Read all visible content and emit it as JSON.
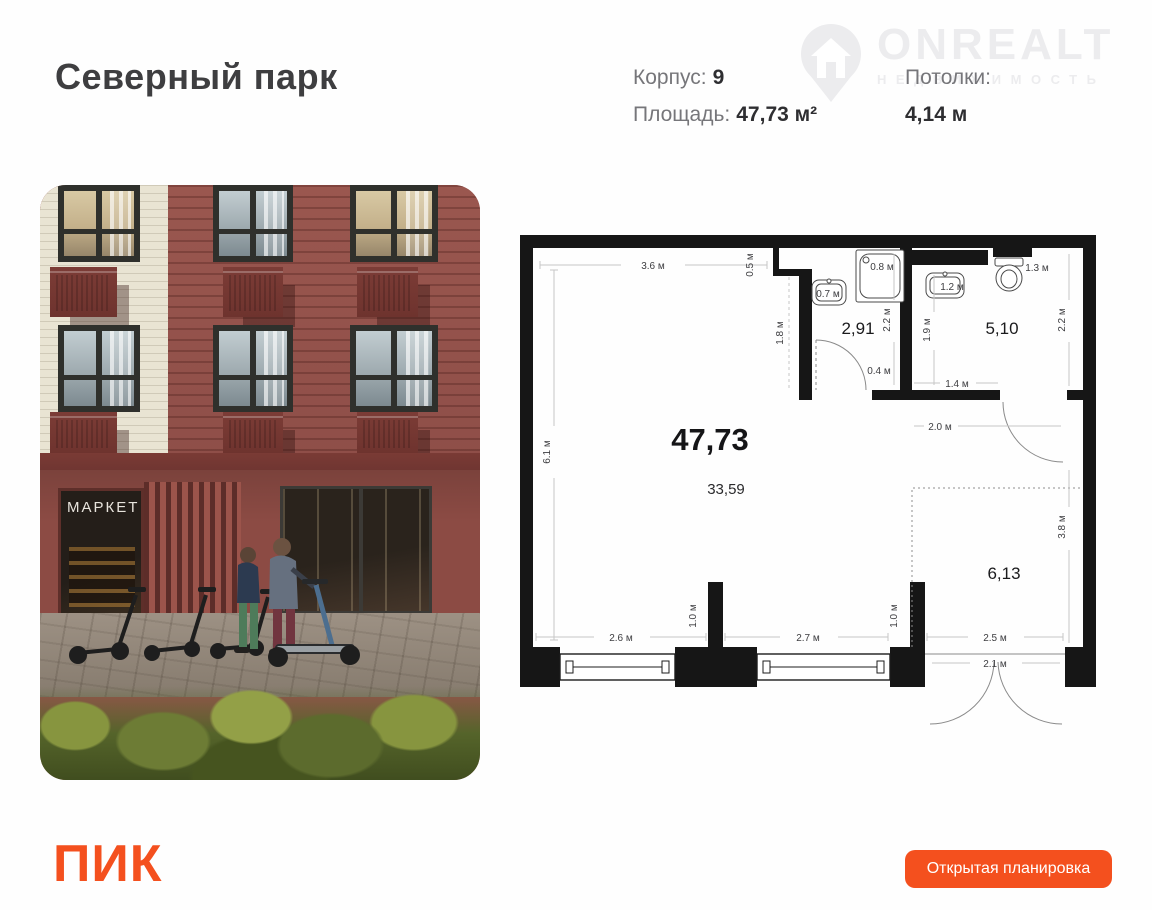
{
  "header": {
    "title": "Северный парк",
    "corpus_label": "Корпус:",
    "corpus_value": "9",
    "area_label": "Площадь:",
    "area_value": "47,73 м²",
    "ceiling_label": "Потолки:",
    "ceiling_value": "4,14 м"
  },
  "watermark": {
    "brand": "ONREALT",
    "subtitle": "НЕДВИЖИМОСТЬ"
  },
  "photo": {
    "market_sign": "МАРКЕТ"
  },
  "plan": {
    "area_total": "47,73",
    "area_main": "33,59",
    "area_bath1": "2,91",
    "area_bath2": "5,10",
    "area_zone": "6,13",
    "dim_top": "3.6 м",
    "dim_niche": "0.5 м",
    "dim_inner_wall": "1.8 м",
    "dim_left": "6.1 м",
    "dim_sink1": "0.7 м",
    "dim_shower": "0.8 м",
    "dim_sink2": "1.2 м",
    "dim_toilet": "1.3 м",
    "dim_bath1_depth": "2.2 м",
    "dim_bath2_left": "1.9 м",
    "dim_right_top": "2.2 м",
    "dim_door_gap": "0.4 м",
    "dim_bath2_width": "1.4 м",
    "dim_hall": "2.0 м",
    "dim_zone_height": "3.8 м",
    "dim_window1": "2.6 м",
    "dim_pier1": "1.0 м",
    "dim_window2": "2.7 м",
    "dim_pier2": "1.0 м",
    "dim_entry": "2.5 м",
    "dim_entry_door": "2.1 м"
  },
  "footer": {
    "logo": "ПИК",
    "button_label": "Открытая планировка"
  },
  "colors": {
    "accent_orange": "#f4501e",
    "wall_black": "#161616",
    "watermark_gray": "#ececee"
  }
}
